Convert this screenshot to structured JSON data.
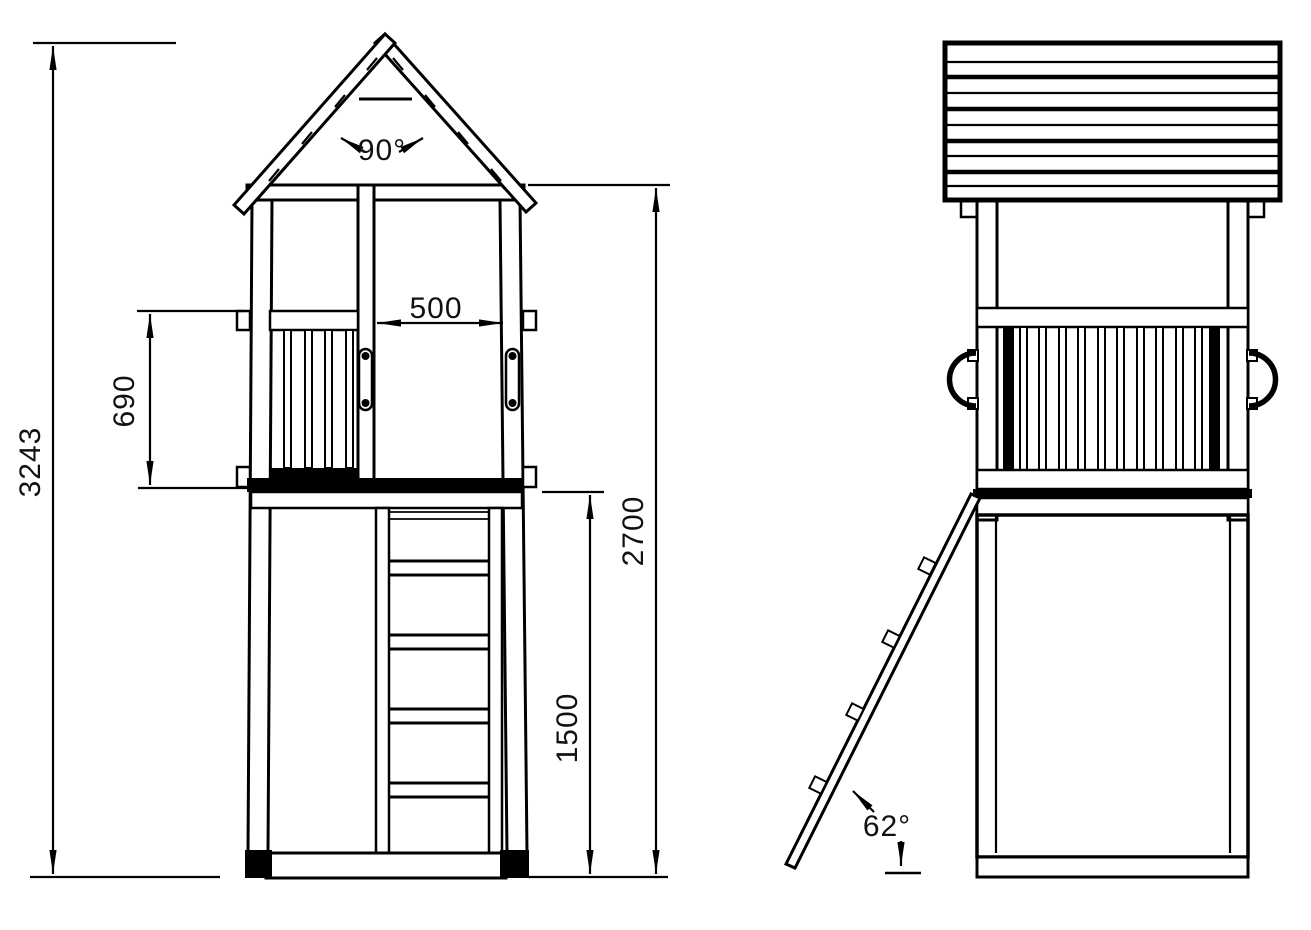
{
  "drawing": {
    "background": "#ffffff",
    "line_color": "#000000",
    "dims": {
      "total_height": "3243",
      "railing_height": "690",
      "opening_width": "500",
      "roof_angle": "90°",
      "post_height": "2700",
      "platform_height": "1500",
      "ladder_angle": "62°"
    }
  }
}
